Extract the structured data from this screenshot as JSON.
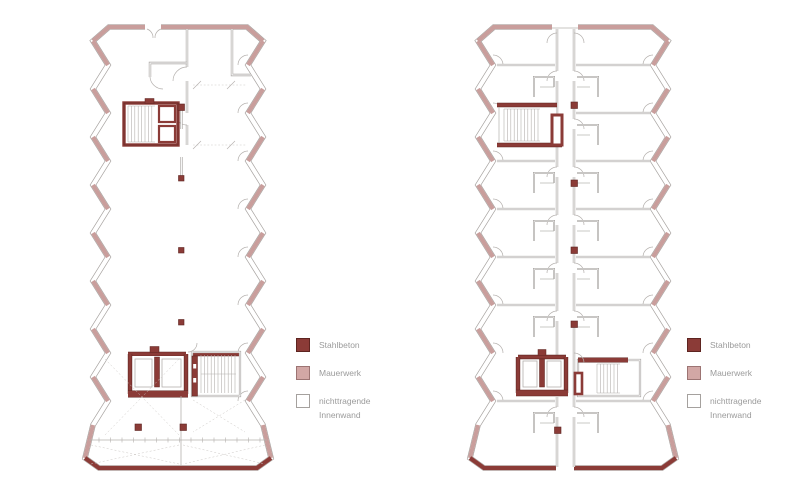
{
  "document": {
    "type": "architectural-floor-plans",
    "plan_count": 2,
    "plans": [
      {
        "id": "floor-plan-left",
        "content": "open floor with two cores, columns and braced base"
      },
      {
        "id": "floor-plan-right",
        "content": "residential floor with central corridor, unit rows and two cores"
      }
    ]
  },
  "legend": {
    "items": [
      {
        "key": "stahlbeton",
        "label": "Stahlbeton"
      },
      {
        "key": "mauerwerk",
        "label": "Mauerwerk"
      },
      {
        "key": "innenwand",
        "label": "nichttragende Innenwand"
      }
    ]
  },
  "colors": {
    "background": "#ffffff",
    "stahlbeton": "#8b3b37",
    "stahlbeton_border": "#5d2420",
    "mauerwerk": "#c99e9c",
    "mauerwerk_swatch": "#d2a7a5",
    "mauerwerk_border": "#9c7473",
    "innenwand_border": "#a5a19e",
    "wall_outline": "#a7a3a0",
    "thin_line": "#b4b0ad",
    "dashed_line": "#ccc8c5",
    "text": "#9b9b9b"
  }
}
